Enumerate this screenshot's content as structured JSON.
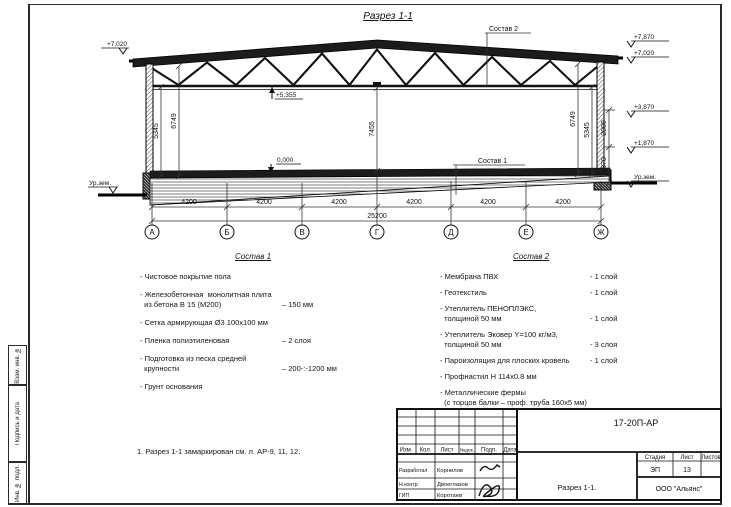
{
  "sheet": {
    "title": "Разрез 1-1",
    "note": "1. Разрез 1-1 замаркирован см. л. АР-9, 11, 12."
  },
  "frame": {
    "stamp_col1": "Взам. инв. №",
    "stamp_col2": "Подпись и дата",
    "stamp_col3": "Инв. № подл."
  },
  "drawing": {
    "leaders": {
      "sostav2": "Состав 2",
      "sostav1": "Состав 1"
    },
    "elevations": {
      "left_top": "+7,020",
      "chord": "+5,355",
      "floor": "0,000",
      "ground_left": "Ур.зем.",
      "right_1": "+7,870",
      "right_2": "+7,020",
      "right_3": "+3,870",
      "right_4": "+1,870",
      "ground_right": "Ур.зем."
    },
    "vdims": {
      "left_outer": "5345",
      "left_inner": "6749",
      "center": "7455",
      "right_inner": "6749",
      "right_outer": "5345",
      "right_upper": "2000",
      "right_lower": "1870"
    },
    "bay_dims": [
      "4200",
      "4200",
      "4200",
      "4200",
      "4200",
      "4200"
    ],
    "total_dim": "25200",
    "axes": [
      "А",
      "Б",
      "В",
      "Г",
      "Д",
      "Е",
      "Ж"
    ]
  },
  "sostav1": {
    "title": "Состав 1",
    "items": [
      {
        "text": "- Чистовое покрытие пола",
        "value": ""
      },
      {
        "text": "- Железобетонная  монолитная плита\n  из бетона В 15 (М200)",
        "value": "– 150 мм"
      },
      {
        "text": "- Сетка армирующая Ø3 100х100 мм",
        "value": ""
      },
      {
        "text": "- Пленка полиэтиленовая",
        "value": "– 2 слоя"
      },
      {
        "text": "- Подготовка из песка средней\n  крупности",
        "value": "– 200-:-1200 мм"
      },
      {
        "text": "- Грунт основания",
        "value": ""
      }
    ]
  },
  "sostav2": {
    "title": "Состав 2",
    "items": [
      {
        "text": "- Мембрана ПВХ",
        "value": "- 1 слой"
      },
      {
        "text": "- Геотекстиль",
        "value": "- 1 слой"
      },
      {
        "text": "- Утеплитель ПЕНОПЛЭКС,\n  толщиной 50 мм",
        "value": "- 1 слой"
      },
      {
        "text": "- Утеплитель Эковер Y=100 кг/м3,\n  толщиной 50 мм",
        "value": "- 3 слоя"
      },
      {
        "text": "- Пароизоляция для плоских кровель",
        "value": "- 1 слой"
      },
      {
        "text": "- Профнастил Н 114х0.8 мм",
        "value": ""
      },
      {
        "text": "- Металлические фермы\n  (с торцов балки – проф. труба 160х5 мм)",
        "value": ""
      }
    ]
  },
  "stamp": {
    "doc_number": "17-20П-АР",
    "headers": {
      "izm": "Изм.",
      "kol": "Кол.",
      "list": "Лист",
      "ndok": "№док.",
      "podp": "Подп.",
      "data": "Дата"
    },
    "rows": [
      {
        "role": "Разработал",
        "name": "Корнилов"
      },
      {
        "role": "Н.контр.",
        "name": "Двоеглазов"
      },
      {
        "role": "ГИП",
        "name": "Коротаев"
      }
    ],
    "stage_label": "Стадия",
    "sheet_label": "Лист",
    "sheets_label": "Листов",
    "stage": "ЭП",
    "sheet_number": "13",
    "sheets": "",
    "drawing_title": "Разрез 1-1.",
    "company": "ООО \"Альянс\""
  }
}
